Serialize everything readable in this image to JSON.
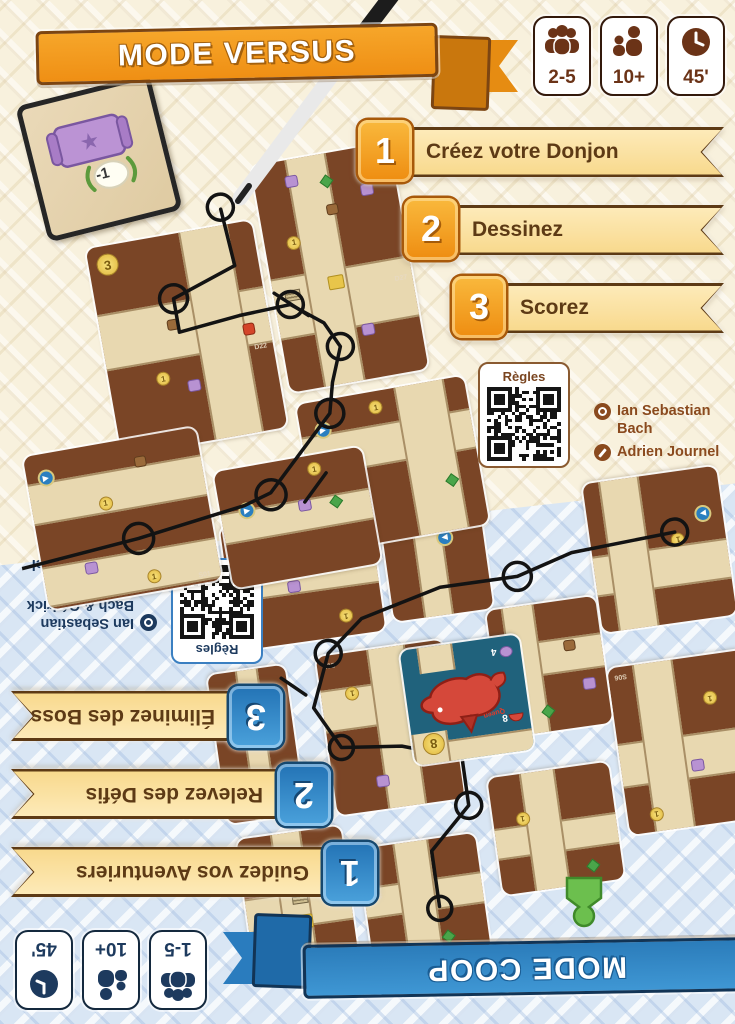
{
  "versus": {
    "title": "MODE VERSUS",
    "badges": {
      "players": "2-5",
      "age": "10+",
      "duration": "45'"
    },
    "steps": [
      {
        "num": "1",
        "label": "Créez votre Donjon"
      },
      {
        "num": "2",
        "label": "Dessinez"
      },
      {
        "num": "3",
        "label": "Scorez"
      }
    ],
    "qr_label": "Règles",
    "credits": {
      "designer": "Ian Sebastian Bach",
      "illustrator": "Adrien Journel"
    },
    "score_card_value": "-1",
    "coin": "1",
    "d22_coin": "3",
    "cards": {
      "c1": "D22",
      "c2": "D27",
      "c3": "S08",
      "c4": "S01"
    }
  },
  "coop": {
    "title": "MODE COOP",
    "badges": {
      "players": "1-5",
      "age": "10+",
      "duration": "45'"
    },
    "steps": [
      {
        "num": "1",
        "label": "Guidez vos Aventuriers"
      },
      {
        "num": "2",
        "label": "Relevez des Défis"
      },
      {
        "num": "3",
        "label": "Éliminez des Boss"
      }
    ],
    "qr_label": "Règles",
    "credits": {
      "designer": "Ian Sebastian Bach & Cédrick Caumont",
      "illustrator": "Adrien Journel"
    },
    "coin": "1",
    "boss": {
      "name": "Queen",
      "coin": "8",
      "mushroom": "8",
      "brain": "4"
    },
    "cards": {
      "c1": "S02",
      "c2": "S04",
      "c3": "S06",
      "c4": "S07"
    }
  }
}
